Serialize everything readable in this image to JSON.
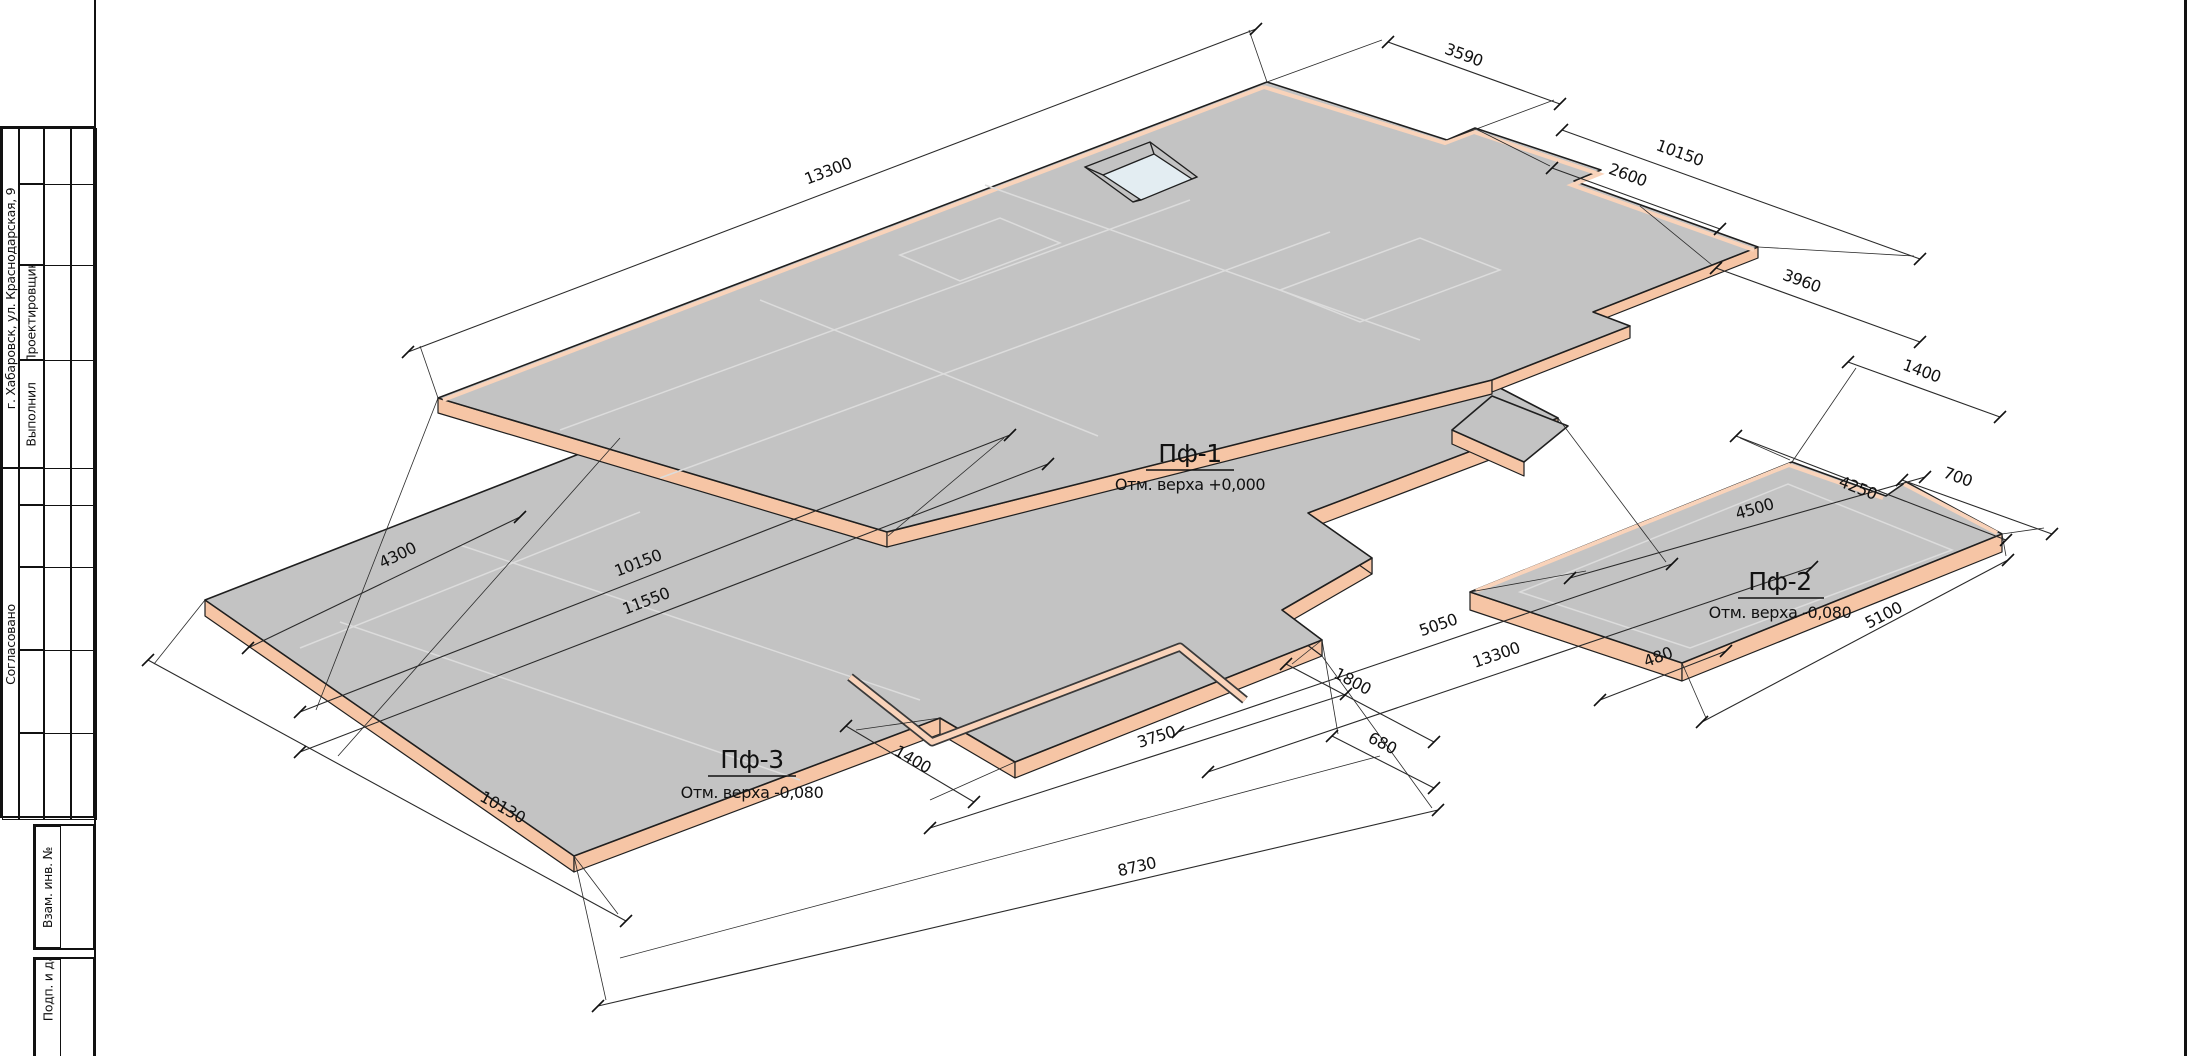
{
  "title_block": {
    "address": "г. Хабаровск, ул. Краснодарская, 9",
    "designer_label": "Проектировщик",
    "executor_label": "Выполнил",
    "agreed_label": "Согласовано",
    "replacement_inv_label": "Взам. инв. №",
    "signature_date_label": "Подп. и дата"
  },
  "slabs": [
    {
      "name": "Пф-1",
      "elevation": "Отм. верха +0,000"
    },
    {
      "name": "Пф-2",
      "elevation": "Отм. верха -0,080"
    },
    {
      "name": "Пф-3",
      "elevation": "Отм. верха -0,080"
    }
  ],
  "dimensions": [
    {
      "value": "13300"
    },
    {
      "value": "3590"
    },
    {
      "value": "10150"
    },
    {
      "value": "2600"
    },
    {
      "value": "3960"
    },
    {
      "value": "1400"
    },
    {
      "value": "700"
    },
    {
      "value": "4250"
    },
    {
      "value": "4500"
    },
    {
      "value": "5100"
    },
    {
      "value": "480"
    },
    {
      "value": "5050"
    },
    {
      "value": "13300"
    },
    {
      "value": "1800"
    },
    {
      "value": "680"
    },
    {
      "value": "3750"
    },
    {
      "value": "1400"
    },
    {
      "value": "8730"
    },
    {
      "value": "10130"
    },
    {
      "value": "11550"
    },
    {
      "value": "10150"
    },
    {
      "value": "4300"
    }
  ],
  "colors": {
    "slab_top": "#c3c3c3",
    "slab_side": "#f6c5a5",
    "slab_side_light": "#f9d3ba",
    "opening_floor": "#e3edf2",
    "outline": "#1f1f1f",
    "faint_line": "#dcdcdc",
    "dim_line": "#2a2a2a"
  }
}
